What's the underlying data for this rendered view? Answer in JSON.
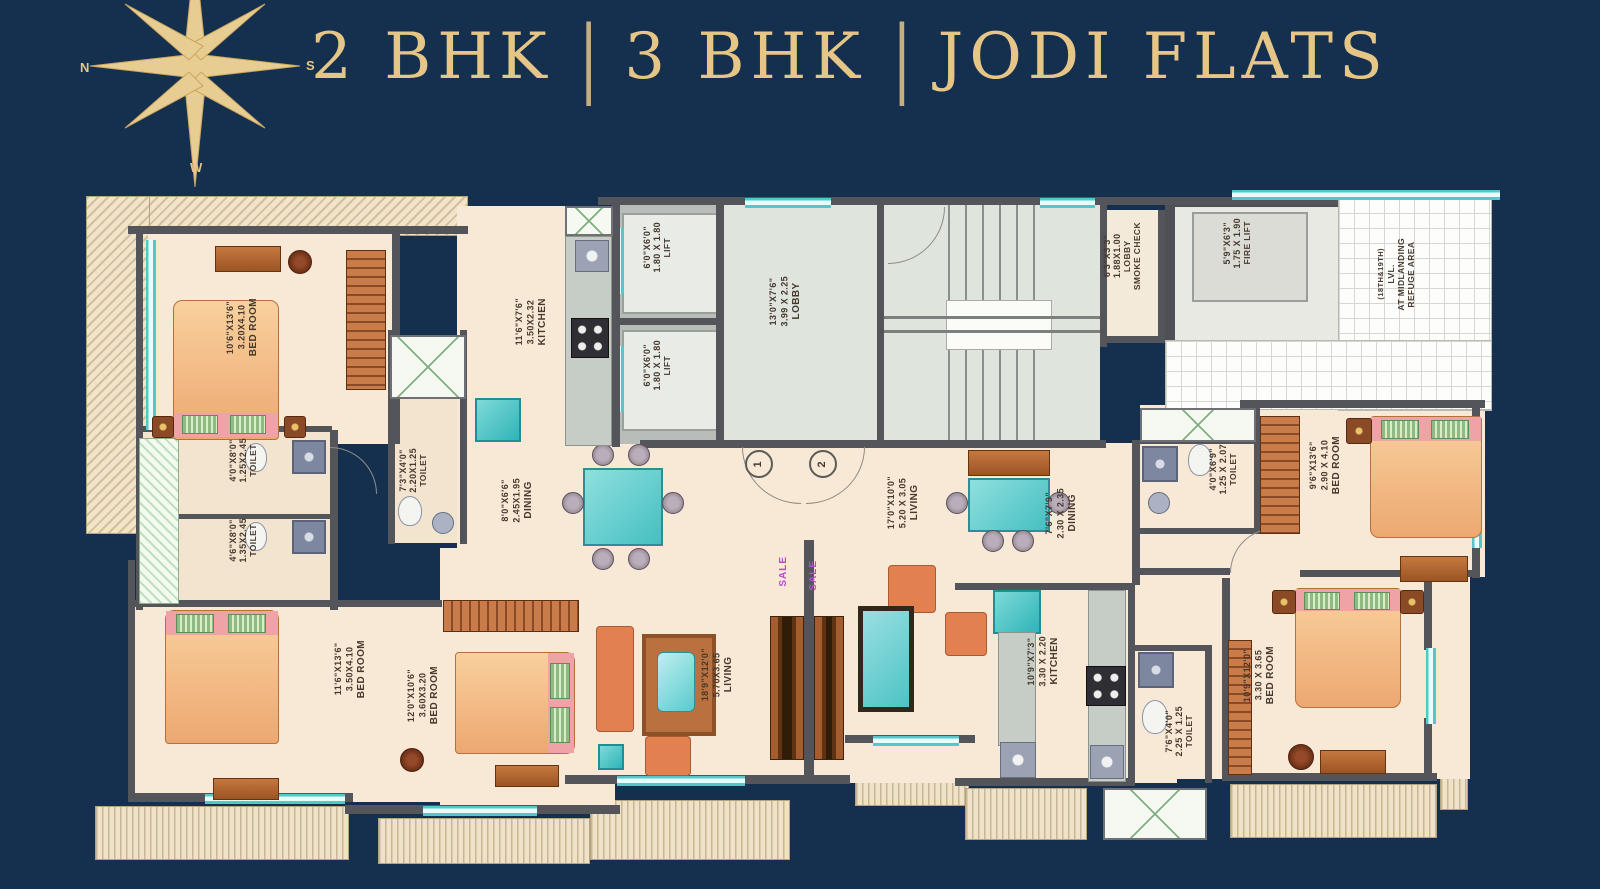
{
  "title": {
    "item1": "2 BHK",
    "sep1": "|",
    "item2": "3 BHK",
    "sep2": "|",
    "item3": "JODI FLATS"
  },
  "compass": {
    "n": "N",
    "s": "S",
    "w": "W"
  },
  "colors": {
    "background": "#15304f",
    "gold": "#e5c687",
    "floor": "#f8e9d6",
    "wall": "#54545b",
    "teal": "#54c7cb",
    "sale": "#b44fc4"
  },
  "plan": {
    "rooms": {
      "bedroom_tl": {
        "name": "BED ROOM",
        "m": "3.20X4.10",
        "ft": "10'6\"X13'6\""
      },
      "toilet_l1": {
        "name": "TOILET",
        "m": "1.25X2.45",
        "ft": "4'0\"X8'0\""
      },
      "toilet_l2": {
        "name": "TOILET",
        "m": "1.35X2.45",
        "ft": "4'6\"X8'0\""
      },
      "bedroom_bl": {
        "name": "BED ROOM",
        "m": "3.50X4.10",
        "ft": "11'6\"X13'6\""
      },
      "toilet_lm": {
        "name": "TOILET",
        "m": "2.20X1.25",
        "ft": "7'3\"X4'0\""
      },
      "kitchen_l": {
        "name": "KITCHEN",
        "m": "3.50X2.32",
        "ft": "11'6\"X7'6\""
      },
      "dining_l": {
        "name": "DINING",
        "m": "2.45X1.95",
        "ft": "8'0\"X6'6\""
      },
      "bedroom_lm": {
        "name": "BED ROOM",
        "m": "3.60X3.20",
        "ft": "12'0\"X10'6\""
      },
      "living_l": {
        "name": "LIVING",
        "m": "5.70X3.65",
        "ft": "18'9\"X12'0\""
      },
      "lift_1": {
        "name": "LIFT",
        "m": "1.80 X 1.80",
        "ft": "6'0\"X6'0\""
      },
      "lift_2": {
        "name": "LIFT",
        "m": "1.80 X 1.80",
        "ft": "6'0\"X6'0\""
      },
      "lobby": {
        "name": "LOBBY",
        "m": "3.99 X 2.25",
        "ft": "13'0\"X7'6\""
      },
      "smoke_lobby": {
        "name": "SMOKE CHECK",
        "name2": "LOBBY",
        "m": "1.88X1.00",
        "ft": "6'3\"X3'3\""
      },
      "fire_lift": {
        "name": "FIRE LIFT",
        "m": "1.75 X 1.90",
        "ft": "5'9\"X6'3\""
      },
      "refuge": {
        "name": "REFUGE AREA",
        "name2": "AT MIDLANDING",
        "name3": "LVL.",
        "sub": "(18TH&19TH)"
      },
      "toilet_tr": {
        "name": "TOILET",
        "m": "1.25 X 2.07",
        "ft": "4'0\"X6'9\""
      },
      "bedroom_tr": {
        "name": "BED ROOM",
        "m": "2.90 X 4.10",
        "ft": "9'6\"X13'6\""
      },
      "living_r": {
        "name": "LIVING",
        "m": "5.20 X 3.05",
        "ft": "17'0\"X10'0\""
      },
      "dining_r": {
        "name": "DINING",
        "m": "2.30 X 2.35",
        "ft": "7'6\"X7'9\""
      },
      "kitchen_r": {
        "name": "KITCHEN",
        "m": "3.30 X 2.20",
        "ft": "10'9\"X7'3\""
      },
      "toilet_br": {
        "name": "TOILET",
        "m": "2.25 X 1.25",
        "ft": "7'6\"X4'0\""
      },
      "bedroom_br": {
        "name": "BED ROOM",
        "m": "3.30 X 3.65",
        "ft": "10'9\"X12'0\""
      }
    },
    "annotations": {
      "sale_a": "SALE",
      "sale_b": "SALE",
      "door_1": "1",
      "door_2": "2"
    }
  }
}
